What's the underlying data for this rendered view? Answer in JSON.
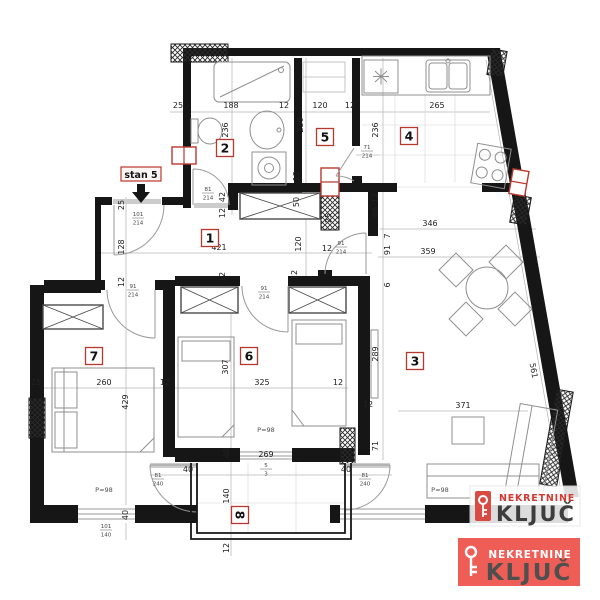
{
  "entrance": {
    "label": "stan 5"
  },
  "rooms": [
    {
      "num": "1",
      "x": 210,
      "y": 238,
      "rot": 0
    },
    {
      "num": "2",
      "x": 225,
      "y": 148,
      "rot": 0
    },
    {
      "num": "3",
      "x": 415,
      "y": 361,
      "rot": 0
    },
    {
      "num": "4",
      "x": 409,
      "y": 136,
      "rot": 0
    },
    {
      "num": "5",
      "x": 325,
      "y": 137,
      "rot": 0
    },
    {
      "num": "6",
      "x": 249,
      "y": 356,
      "rot": 0
    },
    {
      "num": "7",
      "x": 94,
      "y": 356,
      "rot": 0
    },
    {
      "num": "8",
      "x": 240,
      "y": 515,
      "rot": 90
    }
  ],
  "dims": [
    {
      "t": "25",
      "x": 178,
      "y": 108,
      "r": 0
    },
    {
      "t": "188",
      "x": 231,
      "y": 108,
      "r": 0
    },
    {
      "t": "12",
      "x": 284,
      "y": 108,
      "r": 0
    },
    {
      "t": "120",
      "x": 320,
      "y": 108,
      "r": 0
    },
    {
      "t": "12",
      "x": 350,
      "y": 108,
      "r": 0
    },
    {
      "t": "265",
      "x": 437,
      "y": 108,
      "r": 0
    },
    {
      "t": "236",
      "x": 228,
      "y": 130,
      "r": -90
    },
    {
      "t": "236",
      "x": 303,
      "y": 125,
      "r": -90
    },
    {
      "t": "236",
      "x": 378,
      "y": 130,
      "r": -90
    },
    {
      "t": "42",
      "x": 225,
      "y": 197,
      "r": -90
    },
    {
      "t": "12",
      "x": 225,
      "y": 213,
      "r": -90
    },
    {
      "t": "12",
      "x": 299,
      "y": 176,
      "r": -90
    },
    {
      "t": "50",
      "x": 299,
      "y": 202,
      "r": -90
    },
    {
      "t": "25",
      "x": 331,
      "y": 218,
      "r": -90
    },
    {
      "t": "12",
      "x": 378,
      "y": 198,
      "r": -90
    },
    {
      "t": "66",
      "x": 378,
      "y": 212,
      "r": -90
    },
    {
      "t": "7",
      "x": 390,
      "y": 236,
      "r": -90
    },
    {
      "t": "91",
      "x": 390,
      "y": 250,
      "r": -90
    },
    {
      "t": "6",
      "x": 390,
      "y": 285,
      "r": -90
    },
    {
      "t": "25",
      "x": 124,
      "y": 205,
      "r": -90
    },
    {
      "t": "128",
      "x": 124,
      "y": 247,
      "r": -90
    },
    {
      "t": "12",
      "x": 124,
      "y": 282,
      "r": -90
    },
    {
      "t": "421",
      "x": 219,
      "y": 250,
      "r": 0
    },
    {
      "t": "120",
      "x": 301,
      "y": 244,
      "r": -90
    },
    {
      "t": "12",
      "x": 327,
      "y": 251,
      "r": 0
    },
    {
      "t": "346",
      "x": 430,
      "y": 226,
      "r": 0
    },
    {
      "t": "359",
      "x": 428,
      "y": 254,
      "r": 0
    },
    {
      "t": "12",
      "x": 225,
      "y": 277,
      "r": -90
    },
    {
      "t": "12",
      "x": 297,
      "y": 275,
      "r": -90
    },
    {
      "t": "25",
      "x": 36,
      "y": 385,
      "r": 0
    },
    {
      "t": "260",
      "x": 104,
      "y": 385,
      "r": 0
    },
    {
      "t": "12",
      "x": 165,
      "y": 385,
      "r": 0
    },
    {
      "t": "429",
      "x": 128,
      "y": 402,
      "r": -90
    },
    {
      "t": "307",
      "x": 228,
      "y": 367,
      "r": -90
    },
    {
      "t": "325",
      "x": 262,
      "y": 385,
      "r": 0
    },
    {
      "t": "12",
      "x": 338,
      "y": 385,
      "r": 0
    },
    {
      "t": "289",
      "x": 378,
      "y": 354,
      "r": -90
    },
    {
      "t": "12",
      "x": 368,
      "y": 407,
      "r": 0
    },
    {
      "t": "371",
      "x": 463,
      "y": 408,
      "r": 0
    },
    {
      "t": "561",
      "x": 531,
      "y": 371,
      "r": 80
    },
    {
      "t": "71",
      "x": 378,
      "y": 446,
      "r": -90
    },
    {
      "t": "40",
      "x": 229,
      "y": 453,
      "r": -90
    },
    {
      "t": "269",
      "x": 266,
      "y": 457,
      "r": 0
    },
    {
      "t": "40",
      "x": 188,
      "y": 472,
      "r": 0
    },
    {
      "t": "40",
      "x": 346,
      "y": 472,
      "r": 0
    },
    {
      "t": "140",
      "x": 229,
      "y": 496,
      "r": -90
    },
    {
      "t": "40",
      "x": 128,
      "y": 515,
      "r": -90
    },
    {
      "t": "12",
      "x": 229,
      "y": 548,
      "r": -90
    }
  ],
  "door_marks": [
    {
      "w": "101",
      "h": "214",
      "x": 138,
      "y": 217
    },
    {
      "w": "81",
      "h": "214",
      "x": 208,
      "y": 192
    },
    {
      "w": "71",
      "h": "214",
      "x": 367,
      "y": 150
    },
    {
      "w": "91",
      "h": "214",
      "x": 341,
      "y": 246
    },
    {
      "w": "91",
      "h": "214",
      "x": 133,
      "y": 289
    },
    {
      "w": "91",
      "h": "214",
      "x": 264,
      "y": 291
    },
    {
      "w": "81",
      "h": "240",
      "x": 158,
      "y": 478
    },
    {
      "w": "81",
      "h": "240",
      "x": 365,
      "y": 478
    },
    {
      "w": "101",
      "h": "140",
      "x": 106,
      "y": 529
    },
    {
      "w": "5",
      "h": "3",
      "x": 266,
      "y": 468
    }
  ],
  "notes": [
    {
      "t": "P=98",
      "x": 104,
      "y": 492
    },
    {
      "t": "P=98",
      "x": 266,
      "y": 432
    },
    {
      "t": "P=98",
      "x": 440,
      "y": 492
    }
  ],
  "logos": {
    "watermark": {
      "brand": "NEKRETNINE",
      "name": "KLJUČ"
    },
    "badge": {
      "brand": "NEKRETNINE",
      "name": "KLJUČ"
    }
  },
  "colors": {
    "wall": "#161616",
    "dim_text": "#222222",
    "room_box": "#b9382e",
    "logo_red": "#ee5e57",
    "logo_text_red": "#d43a31",
    "logo_text_dark": "#454545"
  }
}
